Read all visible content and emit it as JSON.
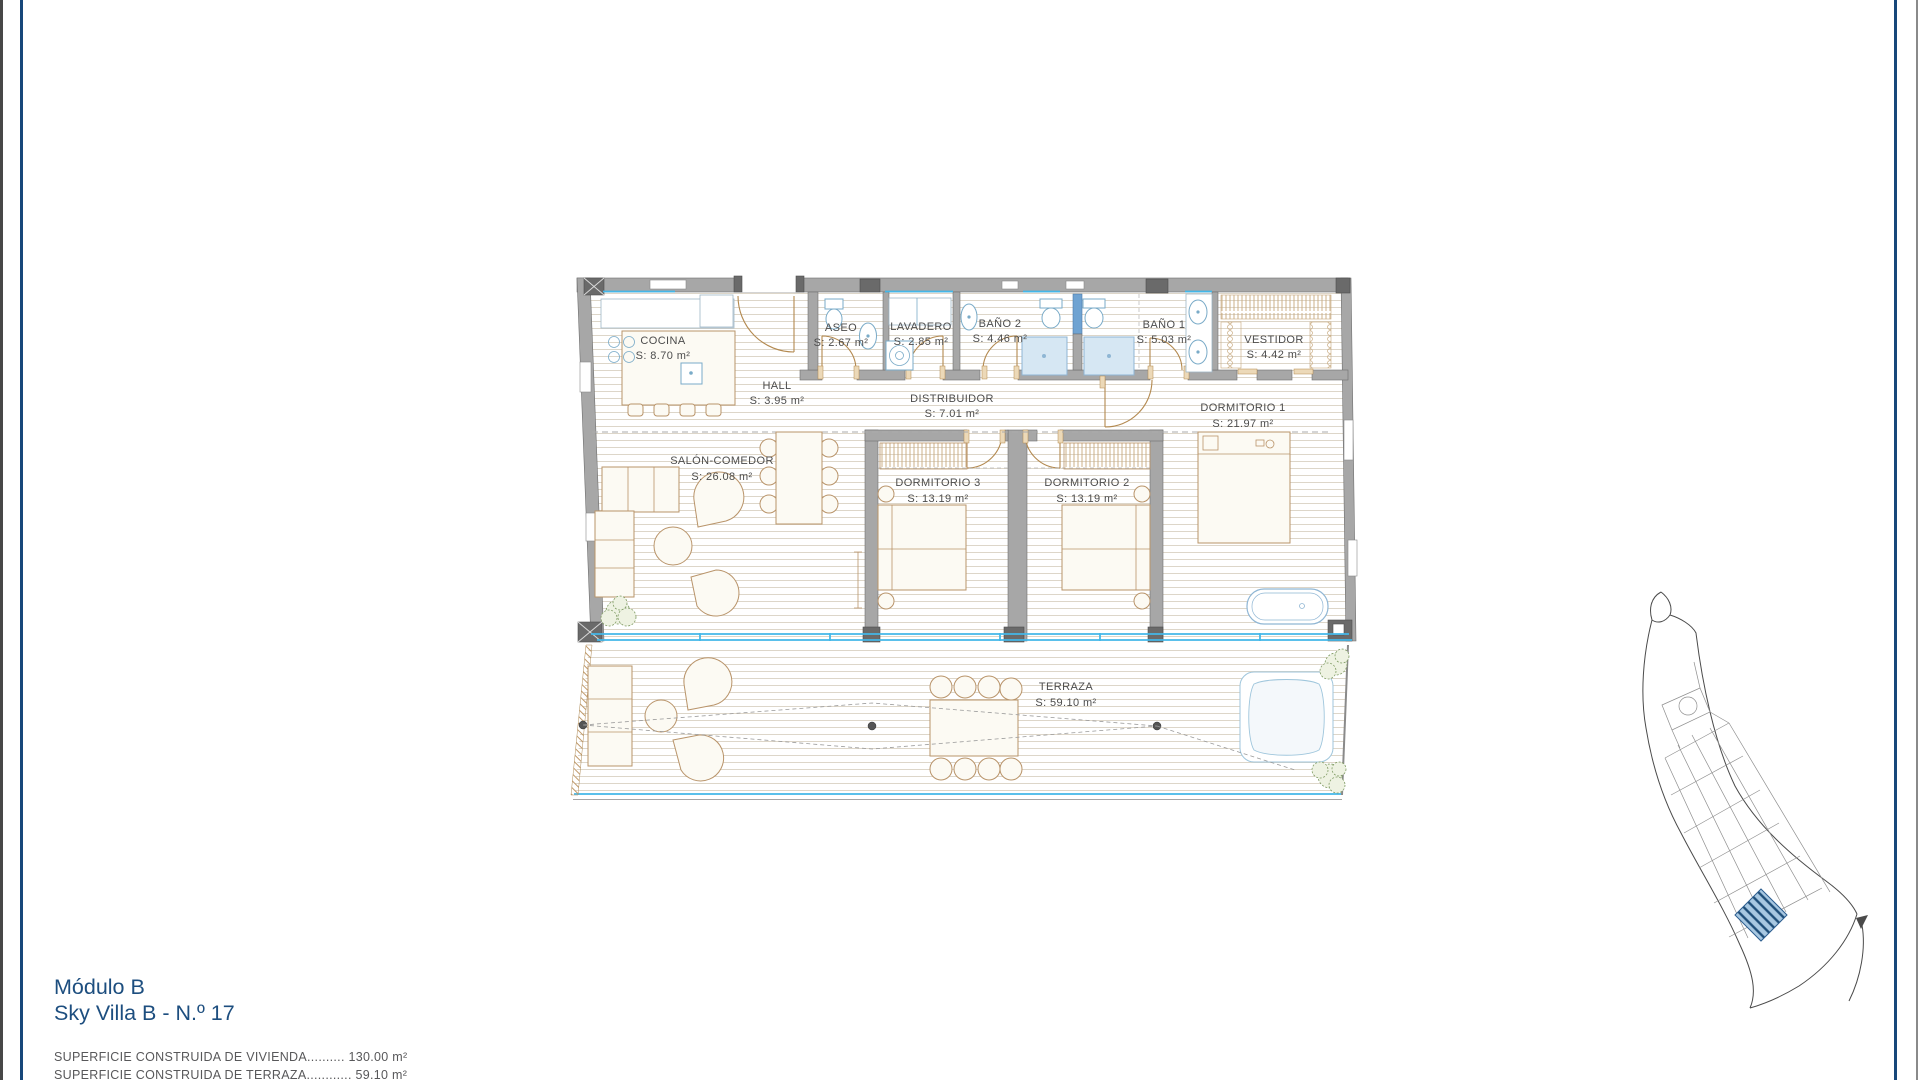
{
  "colors": {
    "frame": "#17477a",
    "title": "#1d4e7f",
    "summary_text": "#58585a",
    "glass": "#43b7e8",
    "wall": "#a7a7a7",
    "furniture": "#b9946a",
    "fixture": "#7aabc8",
    "plot_highlight": "#2b5d8f"
  },
  "title_block": {
    "line1": "Módulo B",
    "line2": "Sky Villa B - N.º 17"
  },
  "summary": [
    {
      "text": "SUPERFICIE CONSTRUIDA DE VIVIENDA.......... 130.00 m²"
    },
    {
      "text": "SUPERFICIE CONSTRUIDA DE TERRAZA............ 59.10 m²"
    }
  ],
  "rooms": [
    {
      "name": "COCINA",
      "area": "S: 8.70 m²"
    },
    {
      "name": "HALL",
      "area": "S: 3.95 m²"
    },
    {
      "name": "ASEO",
      "area": "S: 2.67 m²"
    },
    {
      "name": "LAVADERO",
      "area": "S: 2.85 m²"
    },
    {
      "name": "BAÑO 2",
      "area": "S: 4.46 m²"
    },
    {
      "name": "BAÑO 1",
      "area": "S: 5.03 m²"
    },
    {
      "name": "VESTIDOR",
      "area": "S: 4.42 m²"
    },
    {
      "name": "DISTRIBUIDOR",
      "area": "S: 7.01 m²"
    },
    {
      "name": "DORMITORIO 1",
      "area": "S: 21.97 m²"
    },
    {
      "name": "SALÓN-COMEDOR",
      "area": "S: 26.08 m²"
    },
    {
      "name": "DORMITORIO 3",
      "area": "S: 13.19 m²"
    },
    {
      "name": "DORMITORIO 2",
      "area": "S: 13.19 m²"
    },
    {
      "name": "TERRAZA",
      "area": "S: 59.10 m²"
    }
  ]
}
